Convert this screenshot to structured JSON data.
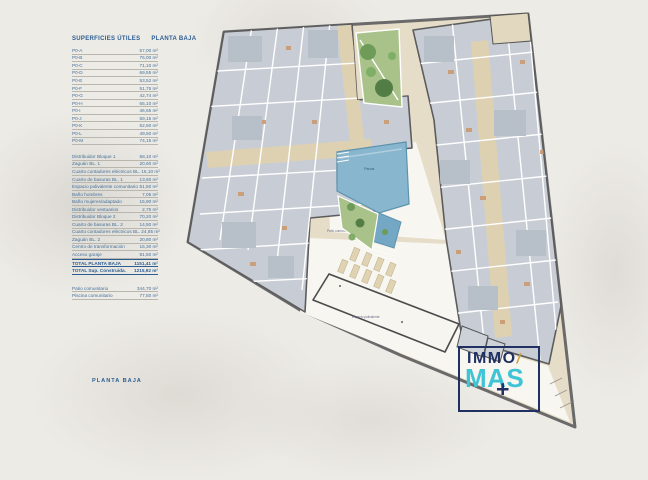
{
  "table": {
    "header": {
      "col1": "SUPERFICIES ÚTILES",
      "col2": "PLANTA BAJA"
    },
    "units_rows": [
      {
        "label": "P0-A",
        "value": "57,00 m²"
      },
      {
        "label": "P0-B",
        "value": "76,00 m²"
      },
      {
        "label": "P0-C",
        "value": "71,10 m²"
      },
      {
        "label": "P0-D",
        "value": "69,55 m²"
      },
      {
        "label": "P0-E",
        "value": "53,52 m²"
      },
      {
        "label": "P0-F",
        "value": "51,75 m²"
      },
      {
        "label": "P0-G",
        "value": "42,74 m²"
      },
      {
        "label": "P0-H",
        "value": "65,10 m²"
      },
      {
        "label": "P0-I",
        "value": "46,65 m²"
      },
      {
        "label": "P0-J",
        "value": "59,15 m²"
      },
      {
        "label": "P0-K",
        "value": "52,50 m²"
      },
      {
        "label": "P0-L",
        "value": "49,50 m²"
      },
      {
        "label": "P0-M",
        "value": "74,15 m²"
      }
    ],
    "common_rows": [
      {
        "label": "Distribuidor Bloque 1",
        "value": "58,10 m²"
      },
      {
        "label": "Zaguán BL. 1",
        "value": "20,60 m²"
      },
      {
        "label": "Cuarto contadores eléctricos BL. 1",
        "value": "5,10 m²"
      },
      {
        "label": "Cuarto de basuras BL. 1",
        "value": "13,60 m²"
      },
      {
        "label": "Espacio polivalente comunitario",
        "value": "51,50 m²"
      },
      {
        "label": "Baño hombres",
        "value": "7,05 m²"
      },
      {
        "label": "Baño mujeres/adaptado",
        "value": "15,90 m²"
      },
      {
        "label": "Distribuidor vestuarios",
        "value": "2,75 m²"
      },
      {
        "label": "Distribuidor Bloque 2",
        "value": "70,20 m²"
      },
      {
        "label": "Cuarto de basuras BL. 2",
        "value": "14,50 m²"
      },
      {
        "label": "Cuarto contadores eléctricos BL. 2",
        "value": "4,85 m²"
      },
      {
        "label": "Zaguán BL. 2",
        "value": "20,80 m²"
      },
      {
        "label": "Centro de transformación",
        "value": "16,30 m²"
      },
      {
        "label": "Acceso garaje",
        "value": "81,50 m²"
      }
    ],
    "total_rows": [
      {
        "label": "TOTAL PLANTA BAJA",
        "value": "1151,41 m²"
      },
      {
        "label": "TOTAL Sup. Construida.",
        "value": "1215,92 m²"
      }
    ],
    "outdoor_rows": [
      {
        "label": "Patio comunitario",
        "value": "344,70 m²"
      },
      {
        "label": "Piscina comunitario",
        "value": "77,50 m²"
      }
    ]
  },
  "plan": {
    "labels": {
      "patio": "Patio comunitario",
      "pool": "Piscina",
      "multipurpose": "Espacio polivalente"
    }
  },
  "footer": {
    "floor_label": "PLANTA BAJA"
  },
  "logo": {
    "line1": "IMMO",
    "accent": "/",
    "line2": "MAS",
    "plus": "+",
    "colors": {
      "navy": "#203063",
      "cyan": "#3fc4d6",
      "gold": "#cda23f"
    }
  }
}
